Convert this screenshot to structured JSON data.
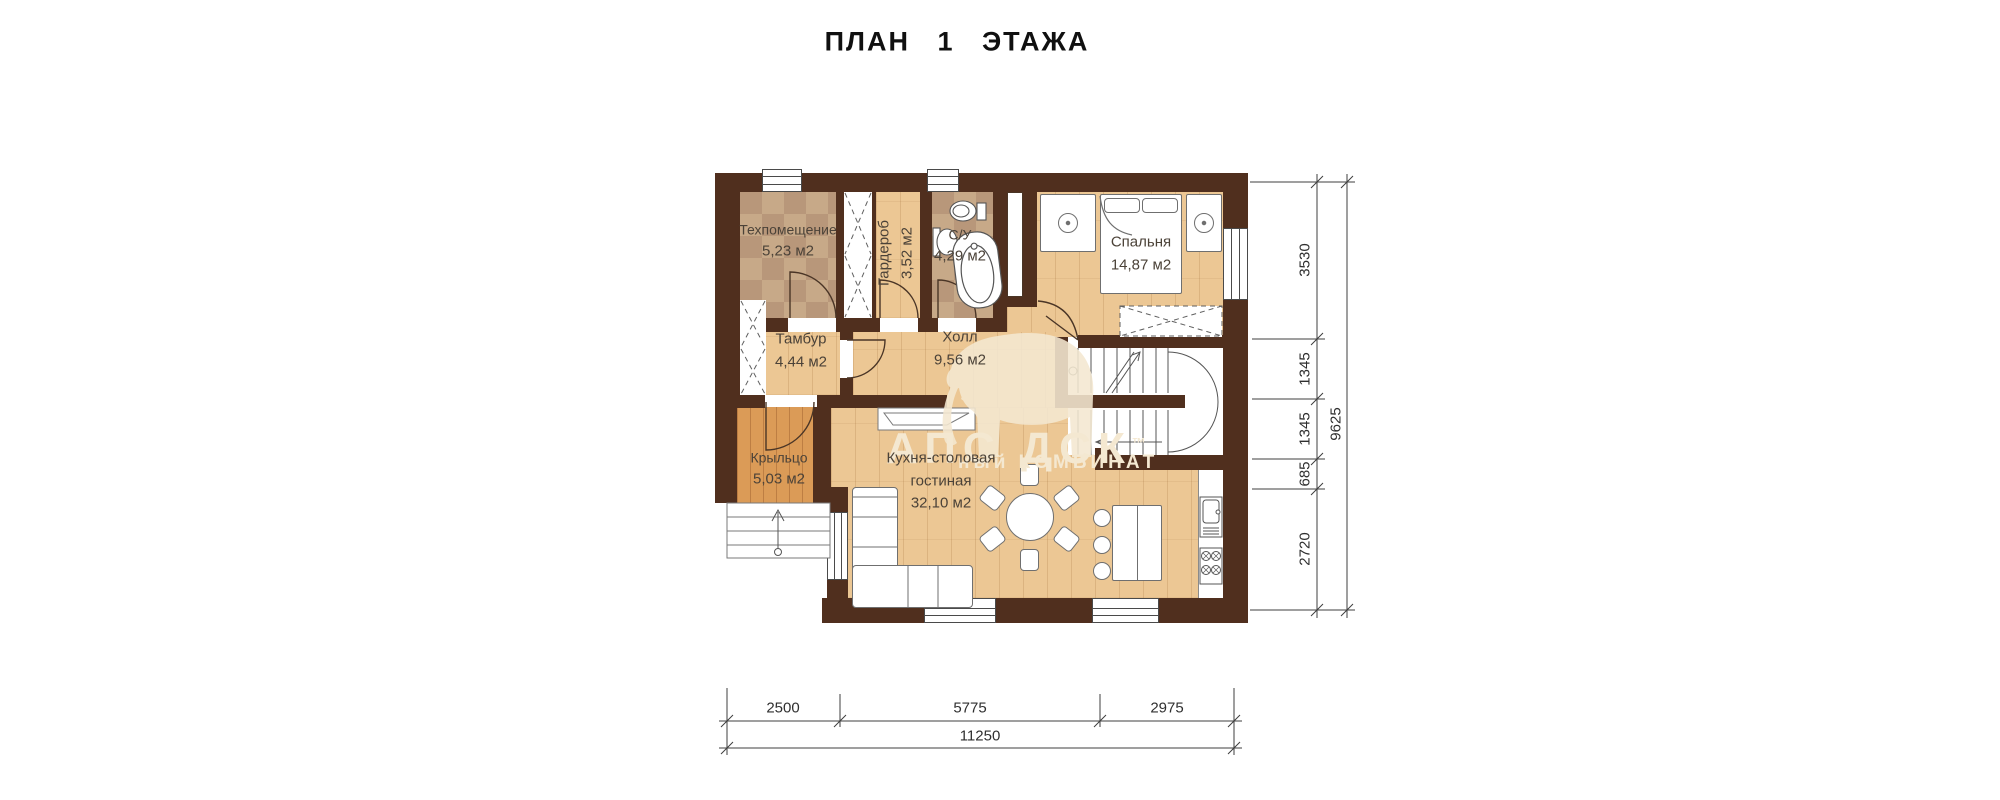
{
  "title": "ПЛАН 1 ЭТАЖА",
  "rooms": [
    {
      "name": "Техпомещение",
      "area": "5,23 м2"
    },
    {
      "name": "Гардероб",
      "area": "3,52 м2"
    },
    {
      "name": "С/У",
      "area": "4,29 м2"
    },
    {
      "name": "Спальня",
      "area": "14,87 м2"
    },
    {
      "name": "Тамбур",
      "area": "4,44 м2"
    },
    {
      "name": "Холл",
      "area": "9,56 м2"
    },
    {
      "name": "Крыльцо",
      "area": "5,03 м2"
    },
    {
      "name": "Кухня-столовая",
      "name2": "гостиная",
      "area": "32,10 м2"
    }
  ],
  "dimensions": {
    "right": {
      "segments": [
        "3530",
        "1345",
        "1345",
        "685",
        "2720"
      ],
      "total": "9625"
    },
    "bottom": {
      "segments": [
        "2500",
        "5775",
        "2975"
      ],
      "total": "11250"
    }
  },
  "watermark": {
    "brand": "АПС ДСК",
    "tm": "™",
    "subtitle": "ный КОМБИНАТ"
  },
  "colors": {
    "wall": "#502f1e",
    "wood": "#ecc794",
    "porch_wood": "#db9b57",
    "tile": "#c7a988",
    "tile_alt": "#b8977a",
    "outline": "#6f6f6f",
    "dim_line": "#3f3f3f",
    "label_text": "#4b4238",
    "watermark": "#f4e8d1",
    "title_text": "#101010"
  }
}
